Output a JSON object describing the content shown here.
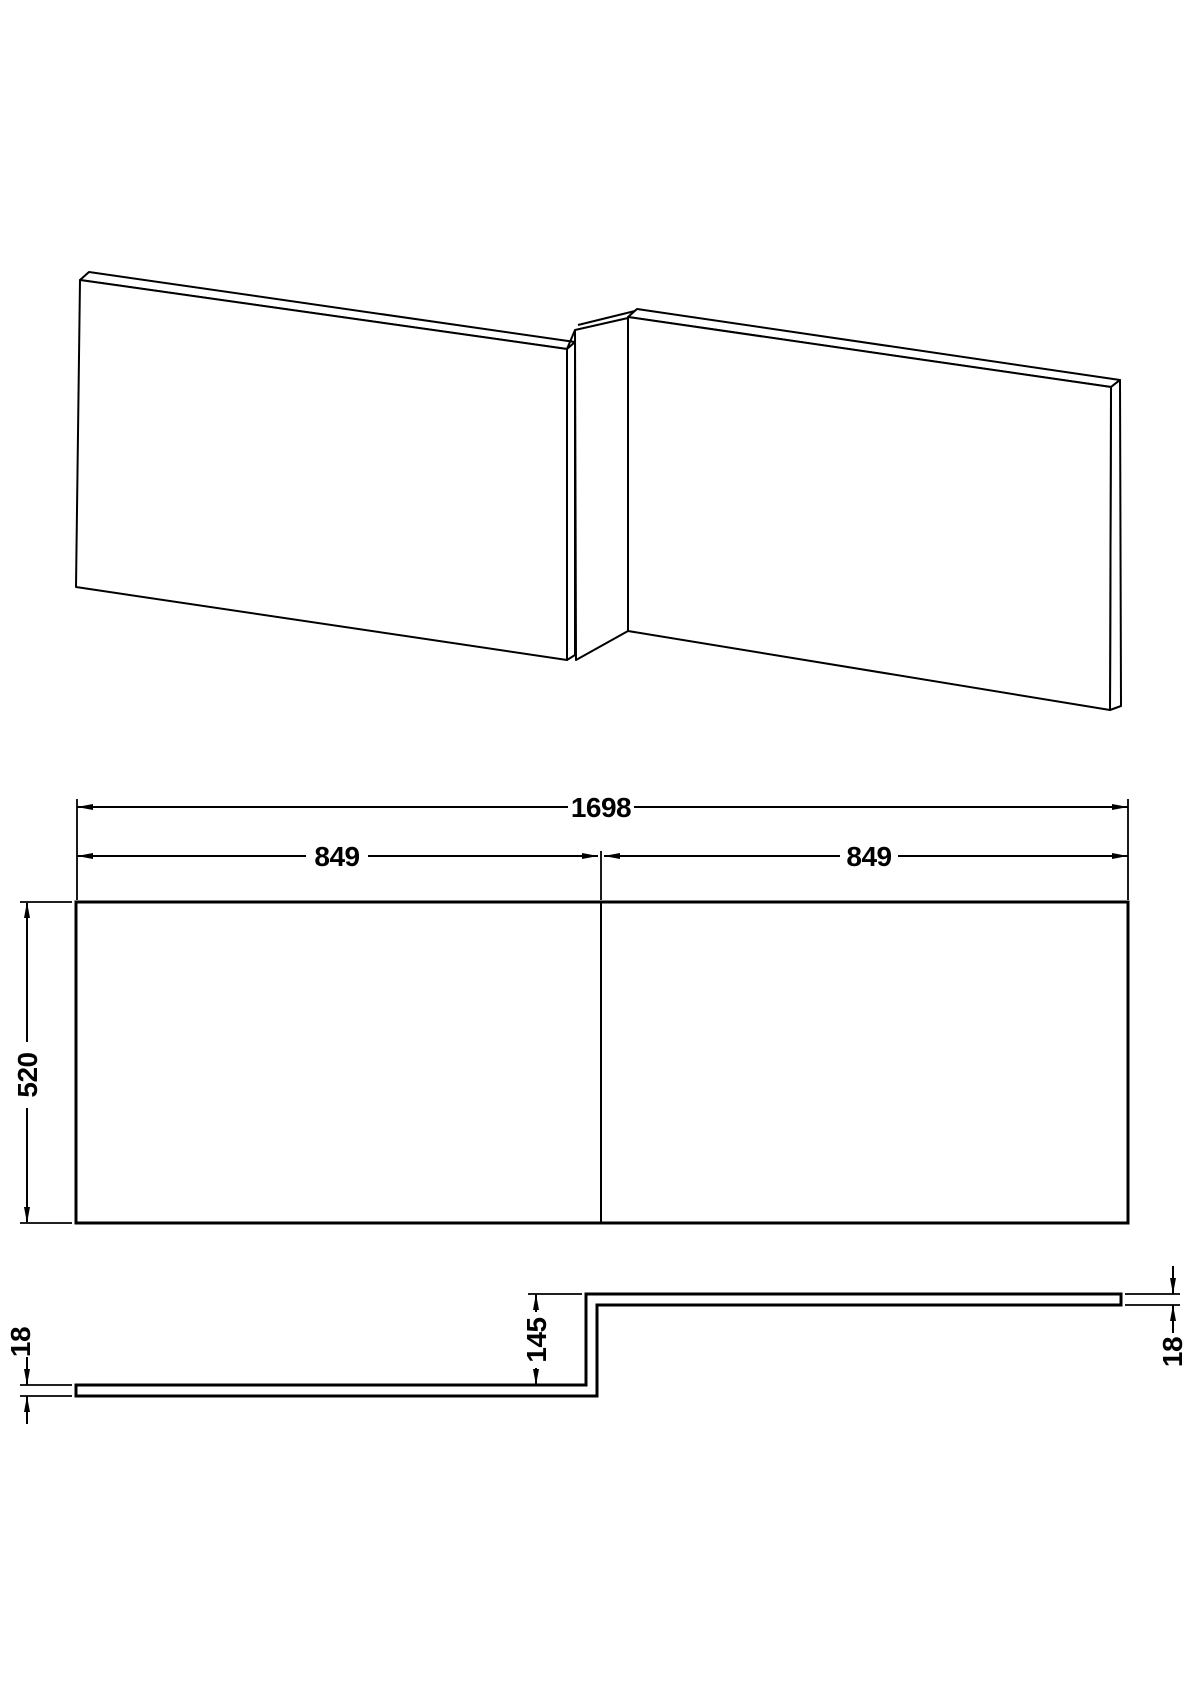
{
  "elevation": {
    "total_width": "1698",
    "left_section_width": "849",
    "right_section_width": "849",
    "panel_height": "520"
  },
  "plan": {
    "step_depth": "145",
    "left_end_thickness": "18",
    "right_end_thickness": "18"
  },
  "colors": {
    "line": "#000000",
    "background": "#ffffff"
  }
}
